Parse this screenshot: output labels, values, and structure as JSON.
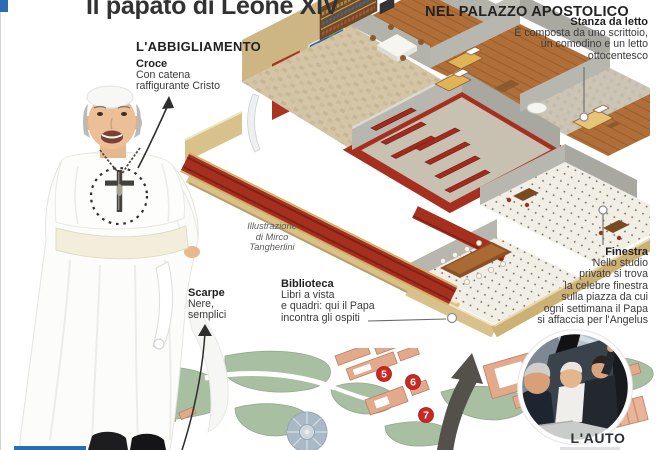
{
  "page": {
    "title": "Il papato di Leone XIV"
  },
  "sections": {
    "clothing": {
      "heading": "L'ABBIGLIAMENTO",
      "cross": {
        "title": "Croce",
        "lines": [
          "Con catena",
          "raffigurante Cristo"
        ]
      },
      "shoes": {
        "title": "Scarpe",
        "lines": [
          "Nere,",
          "semplici"
        ]
      }
    },
    "apartment": {
      "kicker_line1": "L'APPARTAMENTO",
      "kicker_line2": "NEL PALAZZO APOSTOLICO",
      "bedroom": {
        "title": "Stanza da letto",
        "lines": [
          "È composta da uno scrittoio,",
          "un comodino e un letto",
          "ottocentesco"
        ]
      },
      "window": {
        "title": "Finestra",
        "lines": [
          "Nello studio",
          "privato si trova",
          "la celebre finestra",
          "sulla piazza da cui",
          "ogni settimana il Papa",
          "si affaccia per l'Angelus"
        ]
      },
      "library": {
        "title": "Biblioteca",
        "lines": [
          "Libri a vista",
          "e quadri: qui il Papa",
          "incontra gli ospiti"
        ]
      }
    },
    "car": {
      "label": "L'AUTO"
    }
  },
  "credit": {
    "lines": [
      "Illustrazione",
      "di Mirco",
      "Tangherlini"
    ]
  },
  "map": {
    "markers": [
      "5",
      "6",
      "7"
    ]
  },
  "colors": {
    "accent_blue": "#2a6db4",
    "marker_red": "#cb2823",
    "carpet_red": "#9e2a1c"
  }
}
